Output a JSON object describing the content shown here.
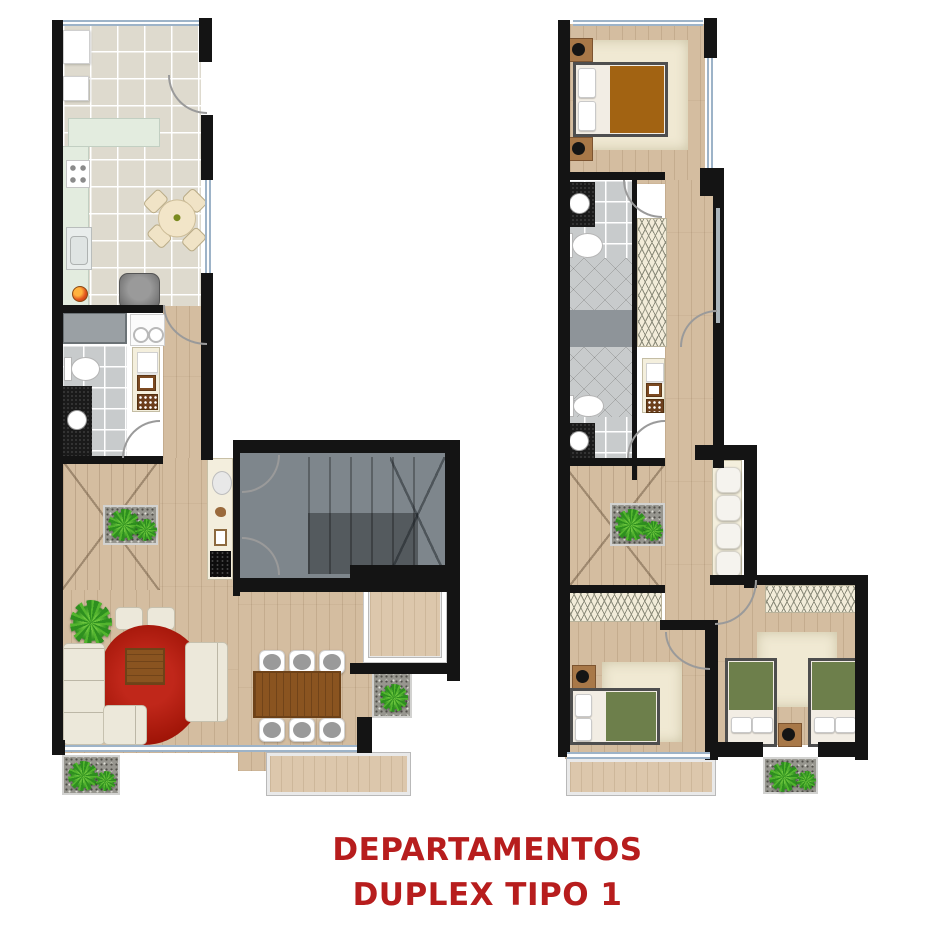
{
  "title": {
    "line1": "DEPARTAMENTOS",
    "line2": "DUPLEX TIPO 1"
  },
  "colors": {
    "title_red": "#b71d1d",
    "wall_black": "#141414",
    "window_blue": "#9db3c8",
    "wood_floor": "#d4bda0",
    "terrace_wood": "#dcc7ac",
    "kitchen_tile": "#dedace",
    "bath_tile": "#c8cbcc",
    "counter_mint": "#e3ecdf",
    "stair_gray": "#7e868c",
    "rug_red": "#a11508",
    "rug_cream": "#f0e9d3",
    "furniture_cream": "#eae6d8",
    "table_wood": "#8a5420",
    "plant_green": "#2e8f1f",
    "blanket_brown": "#a26312",
    "blanket_green": "#6d7f4b"
  },
  "icon_key": {
    "plant-icon": "green pinwheel blob",
    "door-arc-icon": "quarter-circle swing",
    "toilet-icon": "tank + oval bowl",
    "sink-icon": "white circle on black vanity",
    "stair-icon": "treads with diagonal break"
  }
}
